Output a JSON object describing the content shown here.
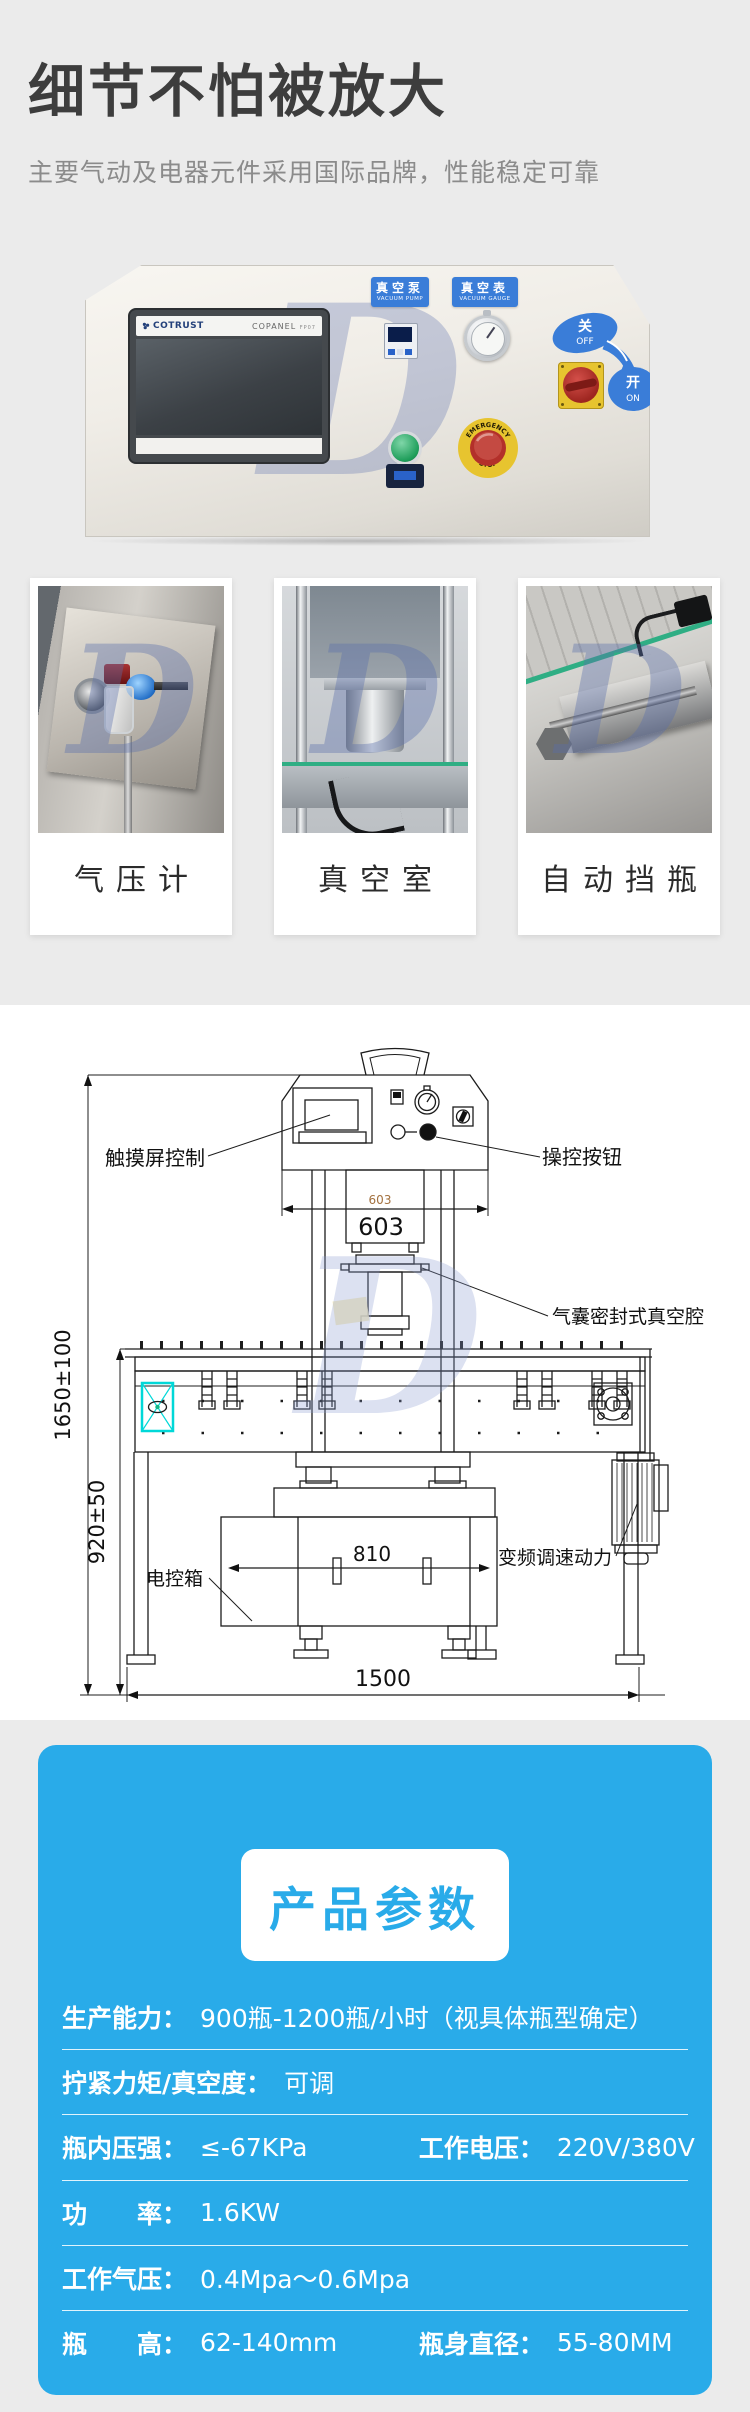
{
  "colors": {
    "page_bg": "#ebebeb",
    "accent_blue": "#29abe9",
    "photo_label_blue": "#3a7dd8",
    "highlight_cyan": "#00d8d8"
  },
  "brand_watermark": "D",
  "hero": {
    "title": "细节不怕被放大",
    "subtitle": "主要气动及电器元件采用国际品牌，性能稳定可靠"
  },
  "panel_photo": {
    "brand": "COTRUST",
    "model": "COPANEL",
    "model_suffix": "FP07",
    "vacuum_pump_cn": "真空泵",
    "vacuum_pump_en": "VACUUM PUMP",
    "vacuum_gauge_cn": "真空表",
    "vacuum_gauge_en": "VACUUM GAUGE",
    "off_cn": "关",
    "off_en": "OFF",
    "on_cn": "开",
    "on_en": "ON",
    "estop_top": "EMERGENCY",
    "estop_bottom": "STOP"
  },
  "feature_cards": [
    {
      "caption": "气压计"
    },
    {
      "caption": "真空室"
    },
    {
      "caption": "自动挡瓶"
    }
  ],
  "drawing": {
    "labels": {
      "touchscreen": "触摸屏控制",
      "control_buttons": "操控按钮",
      "vacuum_chamber": "气囊密封式真空腔",
      "cabinet": "电控箱",
      "motor": "变频调速动力"
    },
    "dims": {
      "head_width_small": "603",
      "head_width": "603",
      "total_height": "1650±100",
      "conveyor_height": "920±50",
      "cabinet_width": "810",
      "total_width": "1500"
    }
  },
  "params": {
    "header": "产品参数",
    "rows": [
      {
        "cols": [
          {
            "label": "生产能力：",
            "value": "900瓶-1200瓶/小时（视具体瓶型确定）"
          }
        ]
      },
      {
        "cols": [
          {
            "label": "拧紧力矩/真空度：",
            "value": "可调"
          }
        ]
      },
      {
        "cols": [
          {
            "label": "瓶内压强：",
            "value": "≤-67KPa"
          },
          {
            "label": "工作电压：",
            "value": "220V/380V"
          }
        ]
      },
      {
        "cols": [
          {
            "label": "功　　率：",
            "value": "1.6KW"
          }
        ]
      },
      {
        "cols": [
          {
            "label": "工作气压：",
            "value": "0.4Mpa～0.6Mpa"
          }
        ]
      },
      {
        "cols": [
          {
            "label": "瓶　　高：",
            "value": "62-140mm"
          },
          {
            "label": "瓶身直径：",
            "value": "55-80MM"
          }
        ]
      }
    ]
  }
}
